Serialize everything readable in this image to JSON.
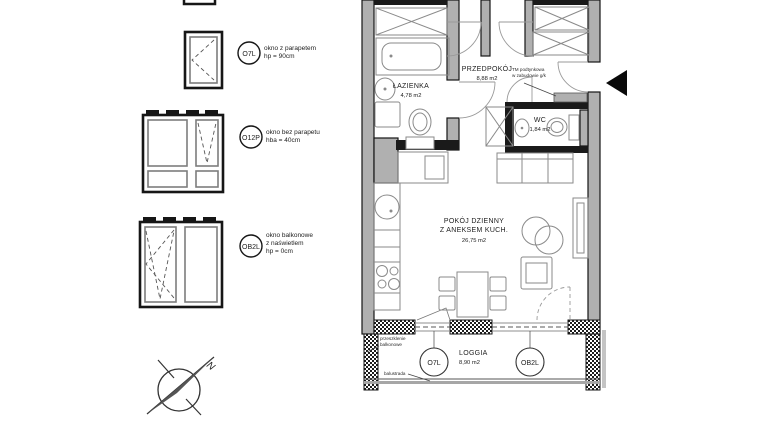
{
  "legend": {
    "items": [
      {
        "code": "O7L",
        "lines": [
          "okno z parapetem",
          "hp = 90cm"
        ]
      },
      {
        "code": "O12P",
        "lines": [
          "okno bez parapetu",
          "hba = 40cm"
        ]
      },
      {
        "code": "OB2L",
        "lines": [
          "okno balkonowe",
          "z naświetlem",
          "hp = 0cm"
        ]
      }
    ]
  },
  "compass": {
    "north": "N"
  },
  "plan": {
    "rooms": {
      "bathroom": {
        "name": "ŁAZIENKA",
        "area": "4,78 m2"
      },
      "hall": {
        "name": "PRZEDPOKÓJ",
        "area": "8,88 m2"
      },
      "wc": {
        "name": "WC",
        "area": "1,84 m2"
      },
      "living": {
        "name1": "POKÓJ DZIENNY",
        "name2": "Z ANEKSEM KUCH.",
        "area": "26,75 m2"
      },
      "loggia": {
        "name": "LOGGIA",
        "area": "8,90 m2"
      }
    },
    "tags": {
      "o7l": "O7L",
      "ob2l": "OB2L"
    },
    "notes": {
      "tm1": "TM podtynkowa",
      "tm2": "w zabudowie g/k",
      "glazing1": "przeszklenie",
      "glazing2": "balkonowe",
      "balustrade": "balustrada"
    }
  }
}
